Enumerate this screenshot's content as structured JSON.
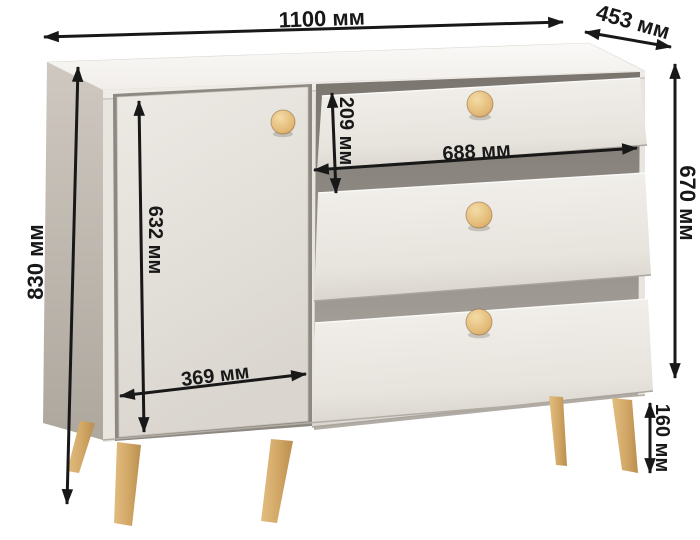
{
  "diagram": {
    "type": "furniture-dimension-diagram",
    "subject": "commode with door and three drawers on tapered wooden legs",
    "unit": "мм",
    "dimensions": {
      "overall_width": {
        "label": "1100 мм",
        "value_mm": 1100
      },
      "depth": {
        "label": "453 мм",
        "value_mm": 453
      },
      "overall_height": {
        "label": "830 мм",
        "value_mm": 830
      },
      "body_height": {
        "label": "670 мм",
        "value_mm": 670
      },
      "drawer_height": {
        "label": "209 мм",
        "value_mm": 209
      },
      "drawer_width": {
        "label": "688 мм",
        "value_mm": 688
      },
      "door_height": {
        "label": "632 мм",
        "value_mm": 632
      },
      "door_width": {
        "label": "369 мм",
        "value_mm": 369
      },
      "leg_height": {
        "label": "160 мм",
        "value_mm": 160
      }
    },
    "colors": {
      "dimension_ink": "#181818",
      "body_light": "#efece8",
      "body_side_shade": "#b9b2a9",
      "wood_knob": "#e4bc7e",
      "wood_leg": "#d2a766",
      "recess_shadow": "#8d8881",
      "background": "#ffffff"
    }
  }
}
